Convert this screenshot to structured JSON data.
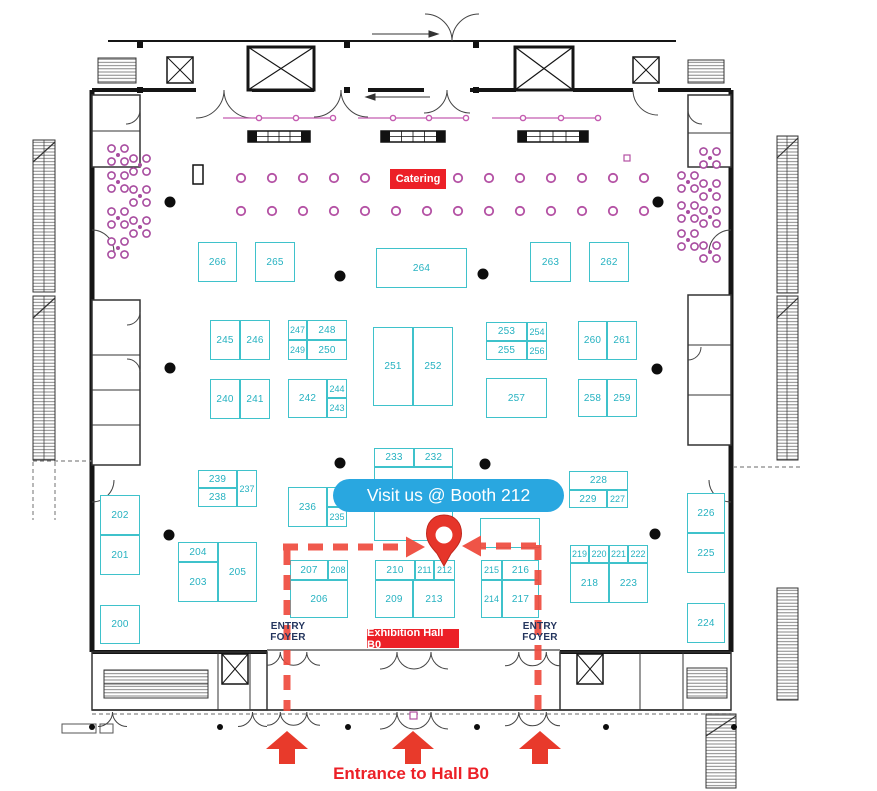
{
  "page": {
    "type": "exhibition-floor-plan"
  },
  "labels": {
    "callout": "Visit us @ Booth 212",
    "catering": "Catering",
    "exhibition_hall": "Exhibition Hall B0",
    "entrance": "Entrance to Hall B0",
    "entry_foyer": [
      "ENTRY",
      "FOYER"
    ]
  },
  "colors": {
    "booth_teal": "#3fc2cb",
    "booth_text_teal": "#26b2c1",
    "badge_red": "#ec2027",
    "route_red": "#ef4b3e",
    "callout_blue": "#29a7e0",
    "catering_purple": "#b451a4",
    "flower_purple": "#a84da0",
    "truss_purple": "#c45cb0",
    "foyer_navy": "#24355e",
    "wall_black": "#151515"
  },
  "booths": [
    {
      "label": "266",
      "x": 198,
      "y": 242,
      "w": 39,
      "h": 40
    },
    {
      "label": "265",
      "x": 255,
      "y": 242,
      "w": 40,
      "h": 40
    },
    {
      "label": "264",
      "x": 376,
      "y": 248,
      "w": 91,
      "h": 40
    },
    {
      "label": "263",
      "x": 530,
      "y": 242,
      "w": 41,
      "h": 40
    },
    {
      "label": "262",
      "x": 589,
      "y": 242,
      "w": 40,
      "h": 40
    },
    {
      "label": "245",
      "x": 210,
      "y": 320,
      "w": 30,
      "h": 40
    },
    {
      "label": "246",
      "x": 240,
      "y": 320,
      "w": 30,
      "h": 40
    },
    {
      "label": "247",
      "x": 288,
      "y": 320,
      "w": 19,
      "h": 20
    },
    {
      "label": "248",
      "x": 307,
      "y": 320,
      "w": 40,
      "h": 20
    },
    {
      "label": "249",
      "x": 288,
      "y": 340,
      "w": 19,
      "h": 20
    },
    {
      "label": "250",
      "x": 307,
      "y": 340,
      "w": 40,
      "h": 20
    },
    {
      "label": "251",
      "x": 373,
      "y": 327,
      "w": 40,
      "h": 79
    },
    {
      "label": "252",
      "x": 413,
      "y": 327,
      "w": 40,
      "h": 79
    },
    {
      "label": "253",
      "x": 486,
      "y": 322,
      "w": 41,
      "h": 19
    },
    {
      "label": "254",
      "x": 527,
      "y": 322,
      "w": 20,
      "h": 19
    },
    {
      "label": "255",
      "x": 486,
      "y": 341,
      "w": 41,
      "h": 19
    },
    {
      "label": "256",
      "x": 527,
      "y": 341,
      "w": 20,
      "h": 19
    },
    {
      "label": "260",
      "x": 578,
      "y": 321,
      "w": 29,
      "h": 39
    },
    {
      "label": "261",
      "x": 607,
      "y": 321,
      "w": 30,
      "h": 39
    },
    {
      "label": "240",
      "x": 210,
      "y": 379,
      "w": 30,
      "h": 40
    },
    {
      "label": "241",
      "x": 240,
      "y": 379,
      "w": 30,
      "h": 40
    },
    {
      "label": "242",
      "x": 288,
      "y": 379,
      "w": 39,
      "h": 39
    },
    {
      "label": "244",
      "x": 327,
      "y": 379,
      "w": 20,
      "h": 19
    },
    {
      "label": "243",
      "x": 327,
      "y": 398,
      "w": 20,
      "h": 20
    },
    {
      "label": "257",
      "x": 486,
      "y": 378,
      "w": 61,
      "h": 40
    },
    {
      "label": "258",
      "x": 578,
      "y": 379,
      "w": 29,
      "h": 38
    },
    {
      "label": "259",
      "x": 607,
      "y": 379,
      "w": 30,
      "h": 38
    },
    {
      "label": "233",
      "x": 374,
      "y": 448,
      "w": 40,
      "h": 19
    },
    {
      "label": "232",
      "x": 414,
      "y": 448,
      "w": 39,
      "h": 19
    },
    {
      "label": "",
      "x": 374,
      "y": 467,
      "w": 79,
      "h": 74
    },
    {
      "label": "",
      "x": 480,
      "y": 518,
      "w": 60,
      "h": 30
    },
    {
      "label": "239",
      "x": 198,
      "y": 470,
      "w": 39,
      "h": 18
    },
    {
      "label": "237",
      "x": 237,
      "y": 470,
      "w": 20,
      "h": 37
    },
    {
      "label": "238",
      "x": 198,
      "y": 488,
      "w": 39,
      "h": 19
    },
    {
      "label": "236",
      "x": 288,
      "y": 487,
      "w": 39,
      "h": 40
    },
    {
      "label": "",
      "x": 327,
      "y": 487,
      "w": 20,
      "h": 20
    },
    {
      "label": "235",
      "x": 327,
      "y": 507,
      "w": 20,
      "h": 20
    },
    {
      "label": "228",
      "x": 569,
      "y": 471,
      "w": 59,
      "h": 19
    },
    {
      "label": "229",
      "x": 569,
      "y": 490,
      "w": 38,
      "h": 18
    },
    {
      "label": "227",
      "x": 607,
      "y": 490,
      "w": 21,
      "h": 18
    },
    {
      "label": "202",
      "x": 100,
      "y": 495,
      "w": 40,
      "h": 40
    },
    {
      "label": "201",
      "x": 100,
      "y": 535,
      "w": 40,
      "h": 40
    },
    {
      "label": "200",
      "x": 100,
      "y": 605,
      "w": 40,
      "h": 39
    },
    {
      "label": "204",
      "x": 178,
      "y": 542,
      "w": 40,
      "h": 20
    },
    {
      "label": "203",
      "x": 178,
      "y": 562,
      "w": 40,
      "h": 40
    },
    {
      "label": "205",
      "x": 218,
      "y": 542,
      "w": 39,
      "h": 60
    },
    {
      "label": "226",
      "x": 687,
      "y": 493,
      "w": 38,
      "h": 40
    },
    {
      "label": "225",
      "x": 687,
      "y": 533,
      "w": 38,
      "h": 40
    },
    {
      "label": "224",
      "x": 687,
      "y": 603,
      "w": 38,
      "h": 40
    },
    {
      "label": "207",
      "x": 290,
      "y": 560,
      "w": 38,
      "h": 20
    },
    {
      "label": "208",
      "x": 328,
      "y": 560,
      "w": 20,
      "h": 20
    },
    {
      "label": "206",
      "x": 290,
      "y": 580,
      "w": 58,
      "h": 38
    },
    {
      "label": "210",
      "x": 375,
      "y": 560,
      "w": 40,
      "h": 20
    },
    {
      "label": "211",
      "x": 415,
      "y": 560,
      "w": 19,
      "h": 20
    },
    {
      "label": "212",
      "x": 434,
      "y": 560,
      "w": 21,
      "h": 20
    },
    {
      "label": "209",
      "x": 375,
      "y": 580,
      "w": 38,
      "h": 38
    },
    {
      "label": "213",
      "x": 413,
      "y": 580,
      "w": 42,
      "h": 38
    },
    {
      "label": "215",
      "x": 481,
      "y": 560,
      "w": 21,
      "h": 20
    },
    {
      "label": "216",
      "x": 502,
      "y": 560,
      "w": 37,
      "h": 20
    },
    {
      "label": "214",
      "x": 481,
      "y": 580,
      "w": 21,
      "h": 38
    },
    {
      "label": "217",
      "x": 502,
      "y": 580,
      "w": 37,
      "h": 38
    },
    {
      "label": "219",
      "x": 570,
      "y": 545,
      "w": 19,
      "h": 18
    },
    {
      "label": "220",
      "x": 589,
      "y": 545,
      "w": 20,
      "h": 18
    },
    {
      "label": "221",
      "x": 609,
      "y": 545,
      "w": 19,
      "h": 18
    },
    {
      "label": "222",
      "x": 628,
      "y": 545,
      "w": 20,
      "h": 18
    },
    {
      "label": "218",
      "x": 570,
      "y": 563,
      "w": 39,
      "h": 40
    },
    {
      "label": "223",
      "x": 609,
      "y": 563,
      "w": 39,
      "h": 40
    }
  ],
  "decor": {
    "columns_large": [
      [
        170,
        202
      ],
      [
        658,
        202
      ],
      [
        340,
        276
      ],
      [
        483,
        274
      ],
      [
        170,
        368
      ],
      [
        657,
        369
      ],
      [
        340,
        463
      ],
      [
        485,
        464
      ],
      [
        169,
        535
      ],
      [
        655,
        534
      ]
    ],
    "columns_small_y": 727,
    "columns_small": [
      92,
      220,
      348,
      477,
      606,
      734
    ],
    "catering_rows": [
      {
        "y": 178,
        "xs": [
          241,
          272,
          303,
          334,
          365,
          458,
          489,
          520,
          551,
          582,
          613,
          644
        ]
      },
      {
        "y": 211,
        "xs": [
          241,
          272,
          303,
          334,
          365,
          396,
          427,
          458,
          489,
          520,
          551,
          582,
          613,
          644
        ]
      }
    ],
    "flowers": [
      [
        118,
        155
      ],
      [
        140,
        165
      ],
      [
        118,
        182
      ],
      [
        140,
        196
      ],
      [
        118,
        218
      ],
      [
        140,
        227
      ],
      [
        118,
        248
      ],
      [
        710,
        158
      ],
      [
        688,
        182
      ],
      [
        710,
        190
      ],
      [
        688,
        212
      ],
      [
        710,
        217
      ],
      [
        688,
        240
      ],
      [
        710,
        252
      ]
    ],
    "truss_lines": [
      {
        "y": 118,
        "x1": 223,
        "x2": 333,
        "nodes": [
          259,
          296,
          333
        ]
      },
      {
        "y": 118,
        "x1": 358,
        "x2": 467,
        "nodes": [
          393,
          429,
          466
        ]
      },
      {
        "y": 118,
        "x1": 492,
        "x2": 598,
        "nodes": [
          523,
          561,
          598
        ]
      }
    ],
    "buffet_tables": [
      [
        248,
        131,
        62,
        11
      ],
      [
        381,
        131,
        64,
        11
      ],
      [
        518,
        131,
        70,
        11
      ]
    ],
    "small_squares": [
      [
        624,
        155,
        6
      ],
      [
        410,
        712,
        7
      ]
    ],
    "podium": {
      "x": 193,
      "y": 165,
      "w": 10,
      "h": 19
    }
  },
  "route": {
    "pin": {
      "x": 444,
      "y": 540
    },
    "up_arrow_xs": [
      287,
      413,
      540
    ],
    "dash_left_x": 287,
    "dash_right_x": 538,
    "dash_y": 547,
    "dash_bottom_y": 711
  }
}
